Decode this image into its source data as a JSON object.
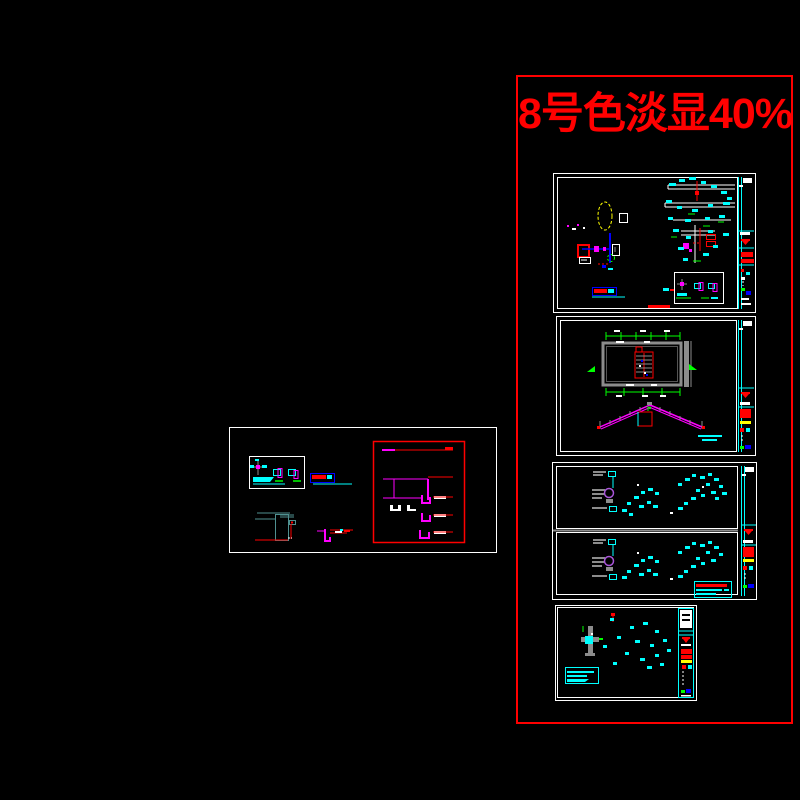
{
  "overlay": {
    "annotation": "8号色淡显40%"
  },
  "palette": {
    "background": "#000000",
    "red": "#ff0000",
    "cyan": "#00ffff",
    "magenta": "#ff00ff",
    "green": "#00ff00",
    "yellow": "#ffff00",
    "blue": "#0000ff",
    "white": "#ffffff",
    "gray": "#8c8c8c",
    "teal": "#4f9090",
    "purple": "#a855d8"
  }
}
